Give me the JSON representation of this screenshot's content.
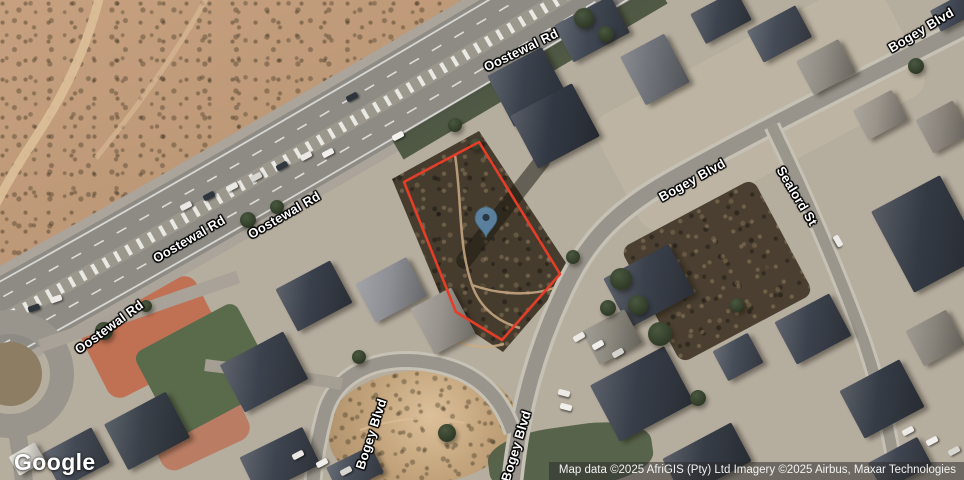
{
  "map_canvas": {
    "view_type": "satellite",
    "provider_logo": "Google",
    "attribution": "Map data ©2025 AfriGIS (Pty) Ltd Imagery ©2025 Airbus, Maxar Technologies",
    "road_labels": [
      {
        "text": "Oostewal Rd",
        "x": 521,
        "y": 50,
        "rotation": -26
      },
      {
        "text": "Oostewal Rd",
        "x": 189,
        "y": 239,
        "rotation": -30
      },
      {
        "text": "Oostewal Rd",
        "x": 284,
        "y": 215,
        "rotation": -30
      },
      {
        "text": "Oostewal Rd",
        "x": 109,
        "y": 327,
        "rotation": -36
      },
      {
        "text": "Bogey Blvd",
        "x": 921,
        "y": 30,
        "rotation": -31
      },
      {
        "text": "Bogey Blvd",
        "x": 692,
        "y": 180,
        "rotation": -29
      },
      {
        "text": "Sealord St",
        "x": 797,
        "y": 196,
        "rotation": 59
      },
      {
        "text": "Bogey Blvd",
        "x": 371,
        "y": 434,
        "rotation": -72
      },
      {
        "text": "Bogey Blvd",
        "x": 516,
        "y": 446,
        "rotation": -73
      }
    ],
    "parcel_outline": {
      "color": "#e53d28",
      "points": "479,142 404,182 456,312 502,340 560,274"
    },
    "marker": {
      "x": 486,
      "y": 238,
      "body_color": "#5d87a8",
      "dot_color": "#273744"
    }
  }
}
